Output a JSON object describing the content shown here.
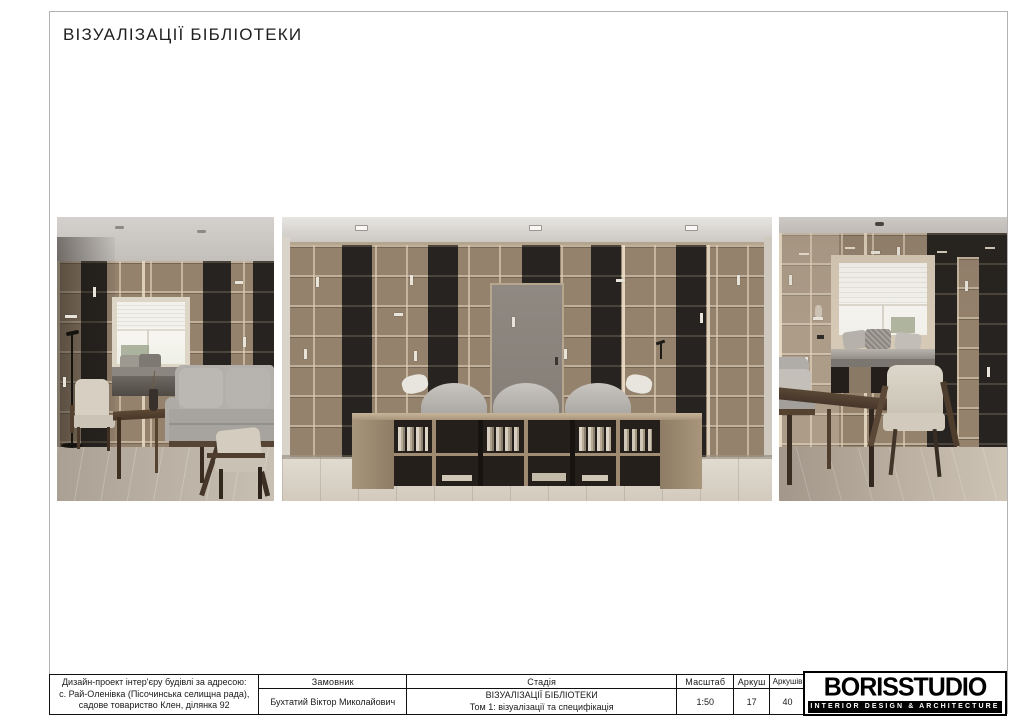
{
  "page": {
    "title": "ВІЗУАЛІЗАЦІЇ БІБЛІОТЕКИ"
  },
  "renders": [
    {
      "alt": "library corner view with window seat, floor lamp, armchairs, coffee table and grey sofa"
    },
    {
      "alt": "frontal view of library bookshelf wall with central door, sofa and low bookcase console"
    },
    {
      "alt": "library corner view with window seat, armchair, dark wood table and sofa edge"
    }
  ],
  "title_block": {
    "project_address": {
      "line1": "Дизайн-проект інтер'єру будівлі за адресою:",
      "line2": "с. Рай-Оленівка (Пісочинська селищна рада),",
      "line3": "садове товариство Клен, ділянка 92"
    },
    "client": {
      "label": "Замовник",
      "value": "Бухтатий Віктор Миколайович"
    },
    "stage": {
      "label": "Стадія",
      "line1": "ВІЗУАЛІЗАЦІЇ БІБЛІОТЕКИ",
      "line2": "Том 1: візуалізації та специфікація"
    },
    "scale": {
      "label": "Масштаб",
      "value": "1:50"
    },
    "sheet": {
      "label": "Аркуш",
      "value": "17"
    },
    "sheets_total": {
      "label": "Аркушів",
      "value": "40"
    },
    "logo": {
      "name": "BORISSTUDIO",
      "tagline": "INTERIOR DESIGN & ARCHITECTURE"
    }
  },
  "colors": {
    "frame_border": "#b2b2b2",
    "table_border": "#101010",
    "logo_bg": "#000000",
    "logo_text": "#ffffff",
    "wood_shelf": "#94826d",
    "dark_shelf": "#262320",
    "sofa_grey": "#b0ada8",
    "floor_light": "#d6cfc4"
  }
}
